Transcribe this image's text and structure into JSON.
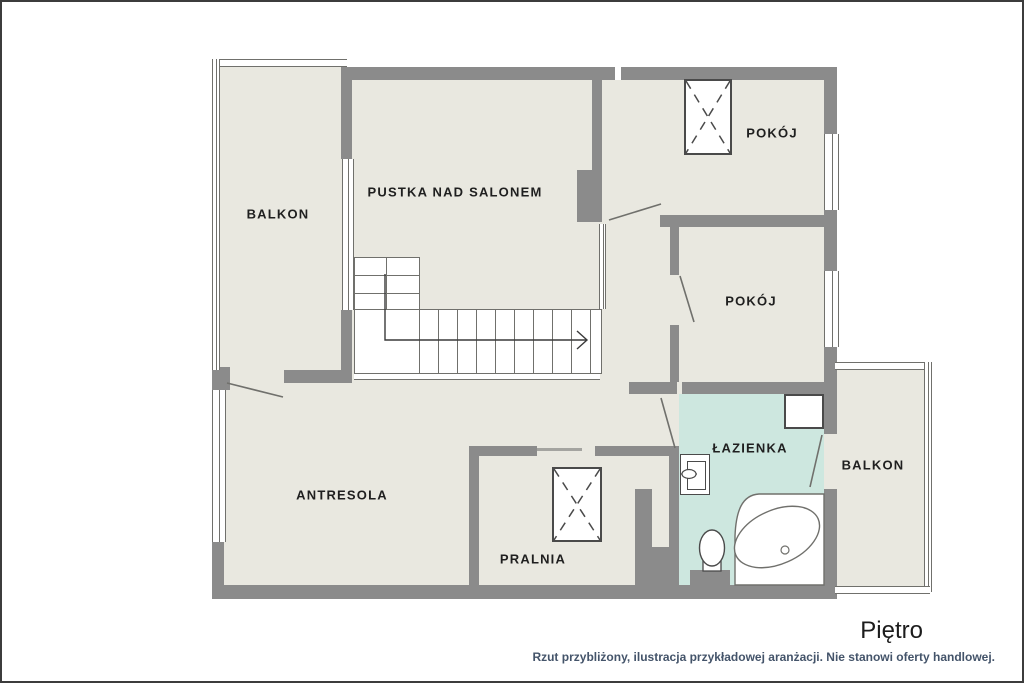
{
  "plan": {
    "title": "Piętro",
    "disclaimer": "Rzut przybliżony, ilustracja przykładowej aranżacji. Nie stanowi oferty handlowej.",
    "rooms": [
      {
        "id": "balkon-left",
        "label": "BALKON"
      },
      {
        "id": "pustka",
        "label": "PUSTKA NAD SALONEM"
      },
      {
        "id": "pokoj-top",
        "label": "POKÓJ"
      },
      {
        "id": "pokoj-bottom",
        "label": "POKÓJ"
      },
      {
        "id": "antresola",
        "label": "ANTRESOLA"
      },
      {
        "id": "pralnia",
        "label": "PRALNIA"
      },
      {
        "id": "lazienka",
        "label": "ŁAZIENKA"
      },
      {
        "id": "balkon-right",
        "label": "BALKON"
      }
    ],
    "colors": {
      "floor": "#e9e8e0",
      "bath": "#cde7df",
      "wall": "#8b8b8b",
      "line": "#70706c",
      "outline": "#4a4a4a",
      "text": "#1f1f1f",
      "disclaimer": "#44546a",
      "canvas": "#ffffff",
      "border": "#3c3c3c"
    }
  }
}
